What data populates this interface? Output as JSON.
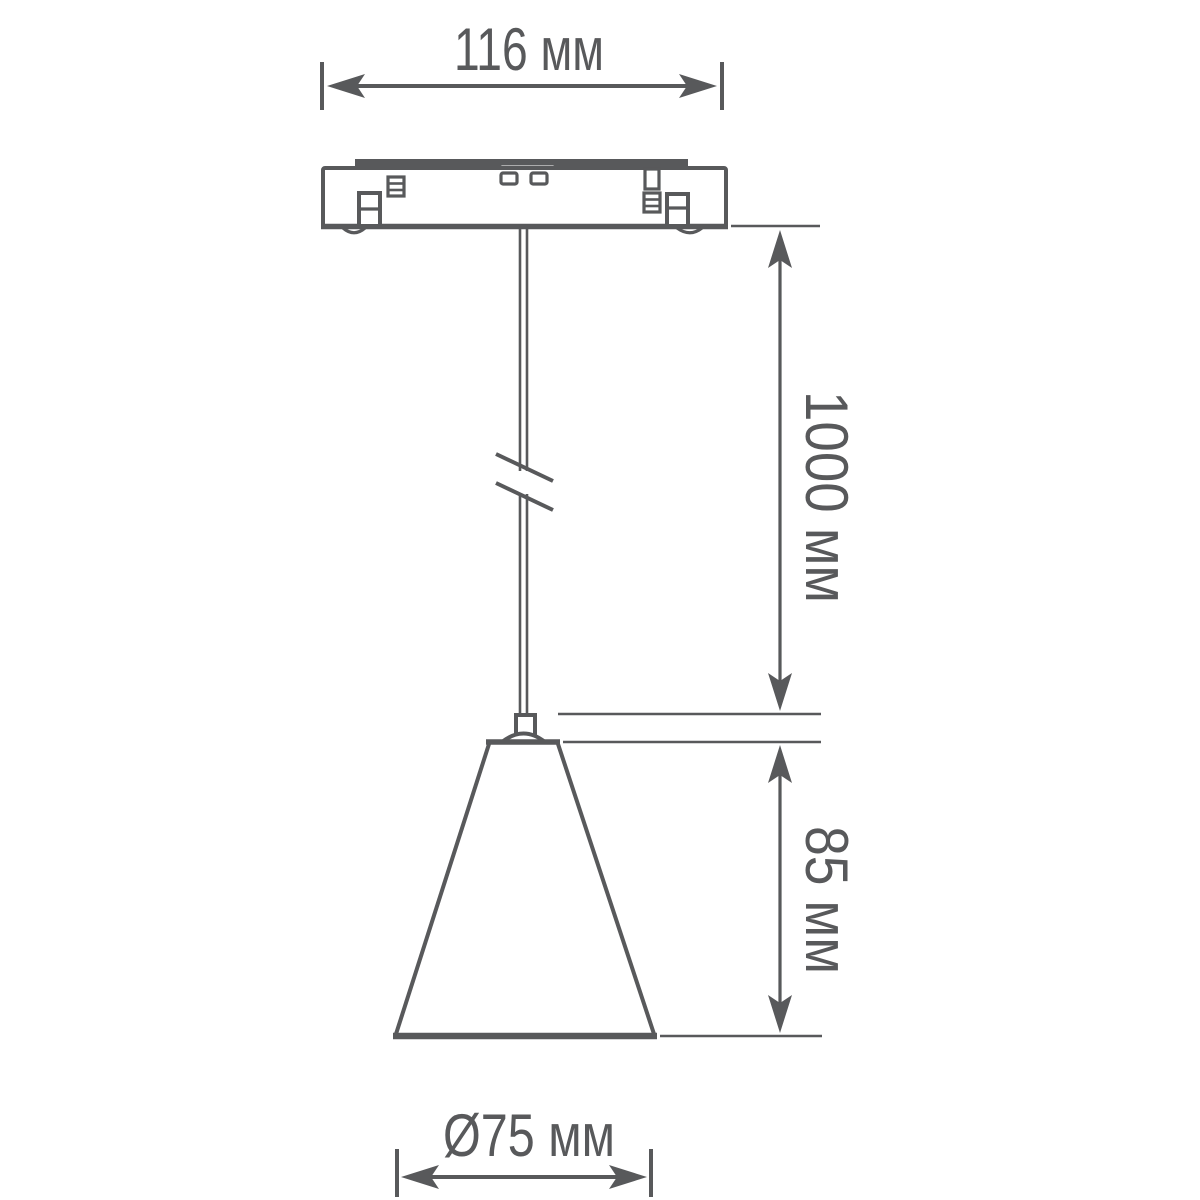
{
  "colors": {
    "line": "#58595B",
    "background": "#FFFFFF"
  },
  "dimensions": {
    "base_width": {
      "value": "116",
      "unit": "мм",
      "label": "116 мм"
    },
    "cord_length": {
      "value": "1000",
      "unit": "мм",
      "label": "1000 мм"
    },
    "shade_height": {
      "value": "85",
      "unit": "мм",
      "label": "85 мм"
    },
    "shade_diameter": {
      "value": "Ø75",
      "unit": "мм",
      "label": "Ø75 мм"
    }
  }
}
